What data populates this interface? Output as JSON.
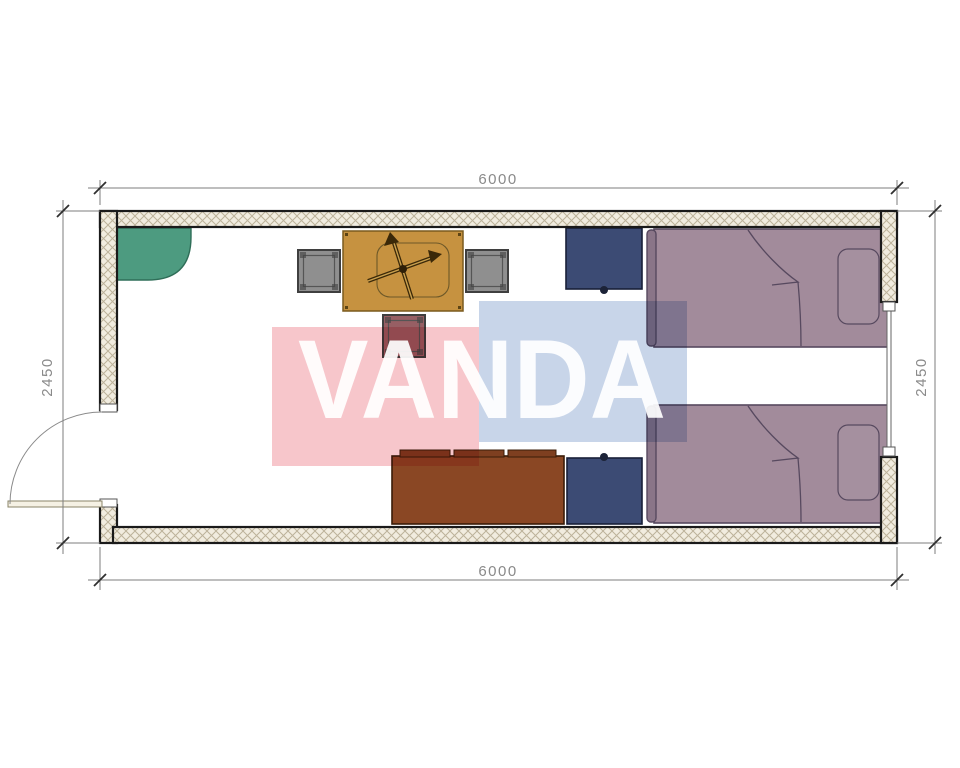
{
  "plan": {
    "dims": {
      "top": "6000",
      "bottom": "6000",
      "left": "2450",
      "right": "2450"
    },
    "watermark": {
      "text": "VANDA",
      "pink": "#f7c6cb",
      "blue": "#c8d5e9",
      "text_color": "#ffffff"
    },
    "palette": {
      "corner_cabinet": "#4d9b80",
      "dining_table": "#c69240",
      "chair_gray": "#8f8f8f",
      "chair_mauve": "#975f64",
      "nightstand": "#3c4b74",
      "sofa": "#8a4724",
      "sofa_cushion": "#7e3f20",
      "bed": "#a28b9b",
      "bed_headboard": "#8a7588",
      "wall_hatch_bg": "#f1ecdf",
      "wall_hatch_line": "#bcb29a",
      "wall_outline": "#1a1a1a"
    }
  }
}
